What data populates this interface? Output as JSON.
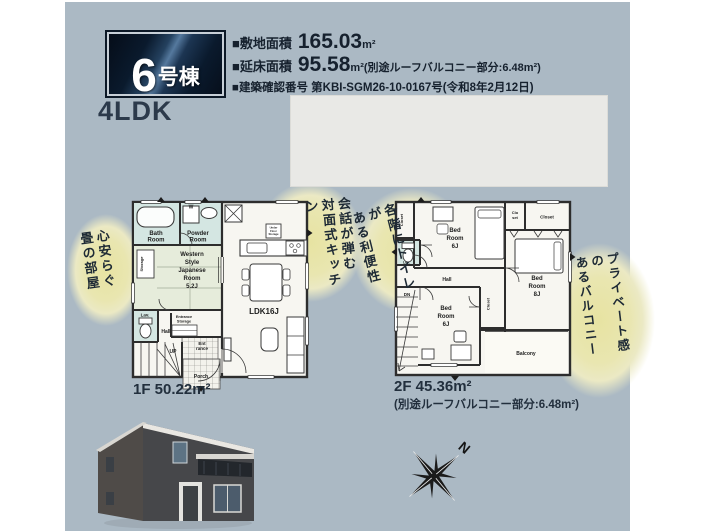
{
  "header": {
    "badge_number": "6",
    "badge_suffix": "号棟",
    "specs": [
      {
        "label": "■敷地面積",
        "value": "165.03",
        "unit": "m²",
        "note": ""
      },
      {
        "label": "■延床面積",
        "value": "95.58",
        "unit": "m²",
        "note": "(別途ルーフバルコニー部分:6.48m²)"
      },
      {
        "text": "■建築確認番号 第KBI-SGM26-10-0167号(令和8年2月12日)"
      }
    ],
    "layout": "4LDK"
  },
  "annotations": {
    "tatami": "心安らぐ\n畳の部屋",
    "kitchen": "会話が弾む\n対面式キッチン",
    "toilet": "各階にトイレが\nある利便性",
    "balcony": "プライベート感の\nあるバルコニー"
  },
  "plan1f": {
    "label": "1F 50.22m²",
    "rooms": {
      "bath": [
        "Bath",
        "Room"
      ],
      "powder": [
        "Powder",
        "Room"
      ],
      "washer": "W",
      "storage": "Storage",
      "japanese": [
        "Western",
        "Style",
        "Japanese",
        "Room",
        "5.2J"
      ],
      "lav": "Lav.",
      "hall": "Hall",
      "up": "UP",
      "ent_storage": [
        "Entrance",
        "Storage"
      ],
      "entrance": [
        "Ent",
        "rance"
      ],
      "porch": "Porch",
      "ldk": "LDK16J",
      "ufs": [
        "Under",
        "Floor",
        "Storage"
      ]
    }
  },
  "plan2f": {
    "label": "2F 45.36m²",
    "note": "(別途ルーフバルコニー部分:6.48m²)",
    "rooms": {
      "closet_left": "Closet",
      "closet_small": [
        "Clo",
        "set"
      ],
      "closet_top": "Closet",
      "closet_mid": "Closet",
      "bed1": [
        "Bed",
        "Room",
        "6J"
      ],
      "bed2": [
        "Bed",
        "Room",
        "6J"
      ],
      "bed3": [
        "Bed",
        "Room",
        "8J"
      ],
      "lav": "Lav.",
      "hall": "Hall",
      "dn": "DN",
      "balcony": "Balcony"
    }
  },
  "compass": {
    "north": "N"
  },
  "colors": {
    "flyer_bg": "#abb9c4",
    "badge_navy": "#0d1d31",
    "highlight_yellow": "#e9e5ab",
    "wet_area_cyan": "#d4e6e2",
    "tatami_green": "#e6ecdb",
    "text_dark": "#1e2a35"
  }
}
